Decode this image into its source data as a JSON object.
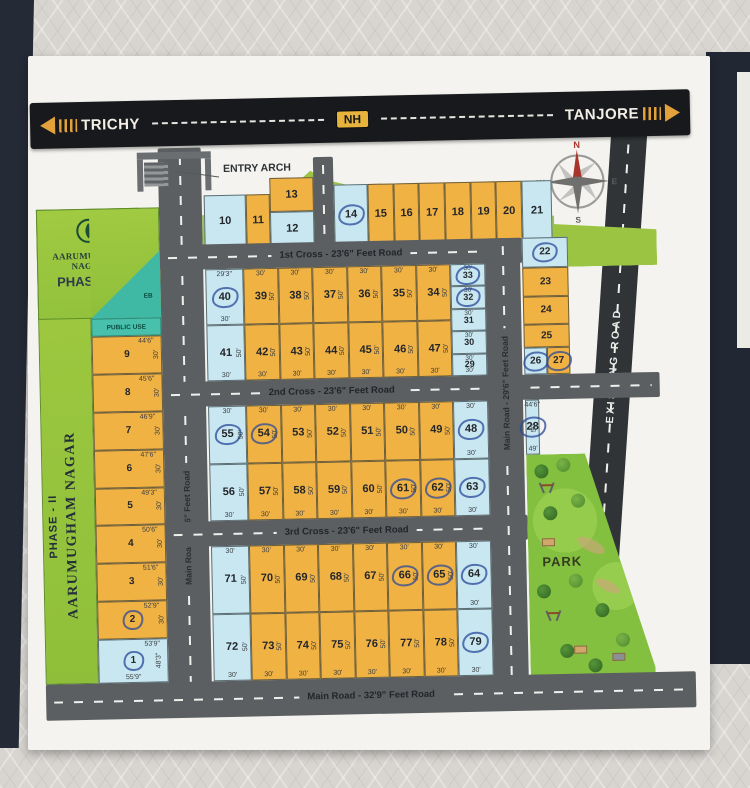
{
  "banner": {
    "left": "TRICHY",
    "badge": "NH",
    "right": "TANJORE"
  },
  "labels": {
    "entry_arch": "ENTRY ARCH",
    "park": "PARK",
    "eb": "EB",
    "public_use": "PUBLIC USE"
  },
  "title_block": {
    "estate_name": "AARUMUGHAM NAGAR",
    "phase": "PHASE - II"
  },
  "compass": {
    "n": "N",
    "e": "E",
    "s": "S",
    "w": "W"
  },
  "roads": {
    "cross1": "1st Cross - 23'6\" Feet Road",
    "cross2": "2nd Cross - 23'6\" Feet Road",
    "cross3": "3rd Cross - 23'6\" Feet Road",
    "main_bottom": "Main Road - 32'9\" Feet Road",
    "main_left": "Main Road - 29'6\" Feet Road",
    "main_right": "Main Road - 29'6\" Feet Road",
    "existing": "EXISTING ROAD"
  },
  "colors": {
    "plot_orange": "#f1b244",
    "plot_blue": "#c8e7f1",
    "road_gray": "#5b5f61",
    "highway_black": "#17191c",
    "arrow_orange": "#e2a13b",
    "nh_badge": "#e7b33c",
    "strip_green": "#97c83e",
    "park_green": "#84c03f",
    "teal": "#3fb9a4",
    "pen_blue": "#2a4898"
  },
  "plots": {
    "west": [
      {
        "n": "9",
        "t": "44'6\"",
        "s": "30'"
      },
      {
        "n": "8",
        "t": "45'6\"",
        "s": "30'"
      },
      {
        "n": "7",
        "t": "46'9\"",
        "s": "30'"
      },
      {
        "n": "6",
        "t": "47'6\"",
        "s": "30'"
      },
      {
        "n": "5",
        "t": "49'3\"",
        "s": "30'"
      },
      {
        "n": "4",
        "t": "50'6\"",
        "s": "30'"
      },
      {
        "n": "3",
        "t": "51'6\"",
        "s": "30'"
      },
      {
        "n": "2",
        "t": "52'9\"",
        "s": "30'",
        "c": true
      },
      {
        "n": "1",
        "t": "53'9\"",
        "s": "48'3\"",
        "bt": "55'9\"",
        "b": true,
        "c": true
      }
    ],
    "top_left": [
      {
        "n": "10",
        "b": true
      },
      {
        "n": "11"
      },
      {
        "stack": [
          {
            "n": "13"
          },
          {
            "n": "12",
            "b": true
          }
        ]
      }
    ],
    "top_right": [
      {
        "n": "14",
        "b": true,
        "c": true
      },
      {
        "n": "15"
      },
      {
        "n": "16"
      },
      {
        "n": "17"
      },
      {
        "n": "18"
      },
      {
        "n": "19"
      },
      {
        "n": "20"
      },
      {
        "n": "21",
        "b": true
      }
    ],
    "row1": [
      {
        "n": "40",
        "b": true,
        "c": true,
        "t": "29'3\"",
        "bt": "30'"
      },
      {
        "n": "39",
        "t": "30'",
        "s": "50'"
      },
      {
        "n": "38",
        "t": "30'",
        "s": "50'"
      },
      {
        "n": "37",
        "t": "30'",
        "s": "50'"
      },
      {
        "n": "36",
        "t": "30'",
        "s": "50'"
      },
      {
        "n": "35",
        "t": "30'",
        "s": "50'"
      },
      {
        "n": "34",
        "t": "30'",
        "s": "50'"
      }
    ],
    "ne": [
      {
        "n": "33",
        "b": true,
        "c": true,
        "t": "30'"
      },
      {
        "n": "32",
        "b": true,
        "c": true,
        "t": "30'"
      },
      {
        "n": "31",
        "b": true,
        "t": "30'"
      },
      {
        "n": "30",
        "b": true,
        "t": "30'"
      },
      {
        "n": "29",
        "b": true,
        "t": "30'",
        "bt": "30'"
      }
    ],
    "row2": [
      {
        "n": "41",
        "b": true,
        "s": "50'",
        "bt": "30'"
      },
      {
        "n": "42",
        "s": "50'",
        "bt": "30'"
      },
      {
        "n": "43",
        "s": "50'",
        "bt": "30'"
      },
      {
        "n": "44",
        "s": "50'",
        "bt": "30'"
      },
      {
        "n": "45",
        "s": "50'",
        "bt": "30'"
      },
      {
        "n": "46",
        "s": "50'",
        "bt": "30'"
      },
      {
        "n": "47",
        "s": "50'",
        "bt": "30'"
      }
    ],
    "row3": [
      {
        "n": "55",
        "b": true,
        "c": true,
        "t": "30'",
        "s": "50'"
      },
      {
        "n": "54",
        "c": true,
        "t": "30'",
        "s": "50'"
      },
      {
        "n": "53",
        "t": "30'",
        "s": "50'"
      },
      {
        "n": "52",
        "t": "30'",
        "s": "50'"
      },
      {
        "n": "51",
        "t": "30'",
        "s": "50'"
      },
      {
        "n": "50",
        "t": "30'",
        "s": "50'"
      },
      {
        "n": "49",
        "t": "30'",
        "s": "50'"
      },
      {
        "n": "48",
        "b": true,
        "c": true,
        "t": "30'",
        "bt": "30'"
      }
    ],
    "row4": [
      {
        "n": "56",
        "b": true,
        "s": "50'",
        "bt": "30'"
      },
      {
        "n": "57",
        "s": "50'",
        "bt": "30'"
      },
      {
        "n": "58",
        "s": "50'",
        "bt": "30'"
      },
      {
        "n": "59",
        "s": "50'",
        "bt": "30'"
      },
      {
        "n": "60",
        "s": "50'",
        "bt": "30'"
      },
      {
        "n": "61",
        "c": true,
        "s": "50'",
        "bt": "30'"
      },
      {
        "n": "62",
        "c": true,
        "s": "50'",
        "bt": "30'"
      },
      {
        "n": "63",
        "b": true,
        "c": true,
        "bt": "30'"
      }
    ],
    "row5": [
      {
        "n": "71",
        "b": true,
        "t": "30'",
        "s": "50'"
      },
      {
        "n": "70",
        "t": "30'",
        "s": "50'"
      },
      {
        "n": "69",
        "t": "30'",
        "s": "50'"
      },
      {
        "n": "68",
        "t": "30'",
        "s": "50'"
      },
      {
        "n": "67",
        "t": "30'",
        "s": "50'"
      },
      {
        "n": "66",
        "c": true,
        "t": "30'",
        "s": "50'"
      },
      {
        "n": "65",
        "c": true,
        "t": "30'",
        "s": "50'"
      },
      {
        "n": "64",
        "b": true,
        "c": true,
        "t": "30'",
        "bt": "30'"
      }
    ],
    "row6": [
      {
        "n": "72",
        "b": true,
        "s": "50'",
        "bt": "30'"
      },
      {
        "n": "73",
        "s": "50'",
        "bt": "30'"
      },
      {
        "n": "74",
        "s": "50'",
        "bt": "30'"
      },
      {
        "n": "75",
        "s": "50'",
        "bt": "30'"
      },
      {
        "n": "76",
        "s": "50'",
        "bt": "30'"
      },
      {
        "n": "77",
        "s": "50'",
        "bt": "30'"
      },
      {
        "n": "78",
        "s": "50'",
        "bt": "30'"
      },
      {
        "n": "79",
        "b": true,
        "c": true,
        "bt": "30'"
      }
    ],
    "east": [
      {
        "n": "22",
        "b": true,
        "c": true
      },
      {
        "n": "23"
      },
      {
        "n": "24"
      },
      {
        "n": "25"
      },
      {
        "hrow": [
          {
            "n": "26",
            "b": true,
            "c": true
          },
          {
            "n": "27",
            "c": true
          }
        ]
      }
    ],
    "p28": [
      {
        "n": "28",
        "b": true,
        "c": true,
        "t": "44'6\"",
        "s": "50'",
        "bt": "49'"
      }
    ]
  }
}
